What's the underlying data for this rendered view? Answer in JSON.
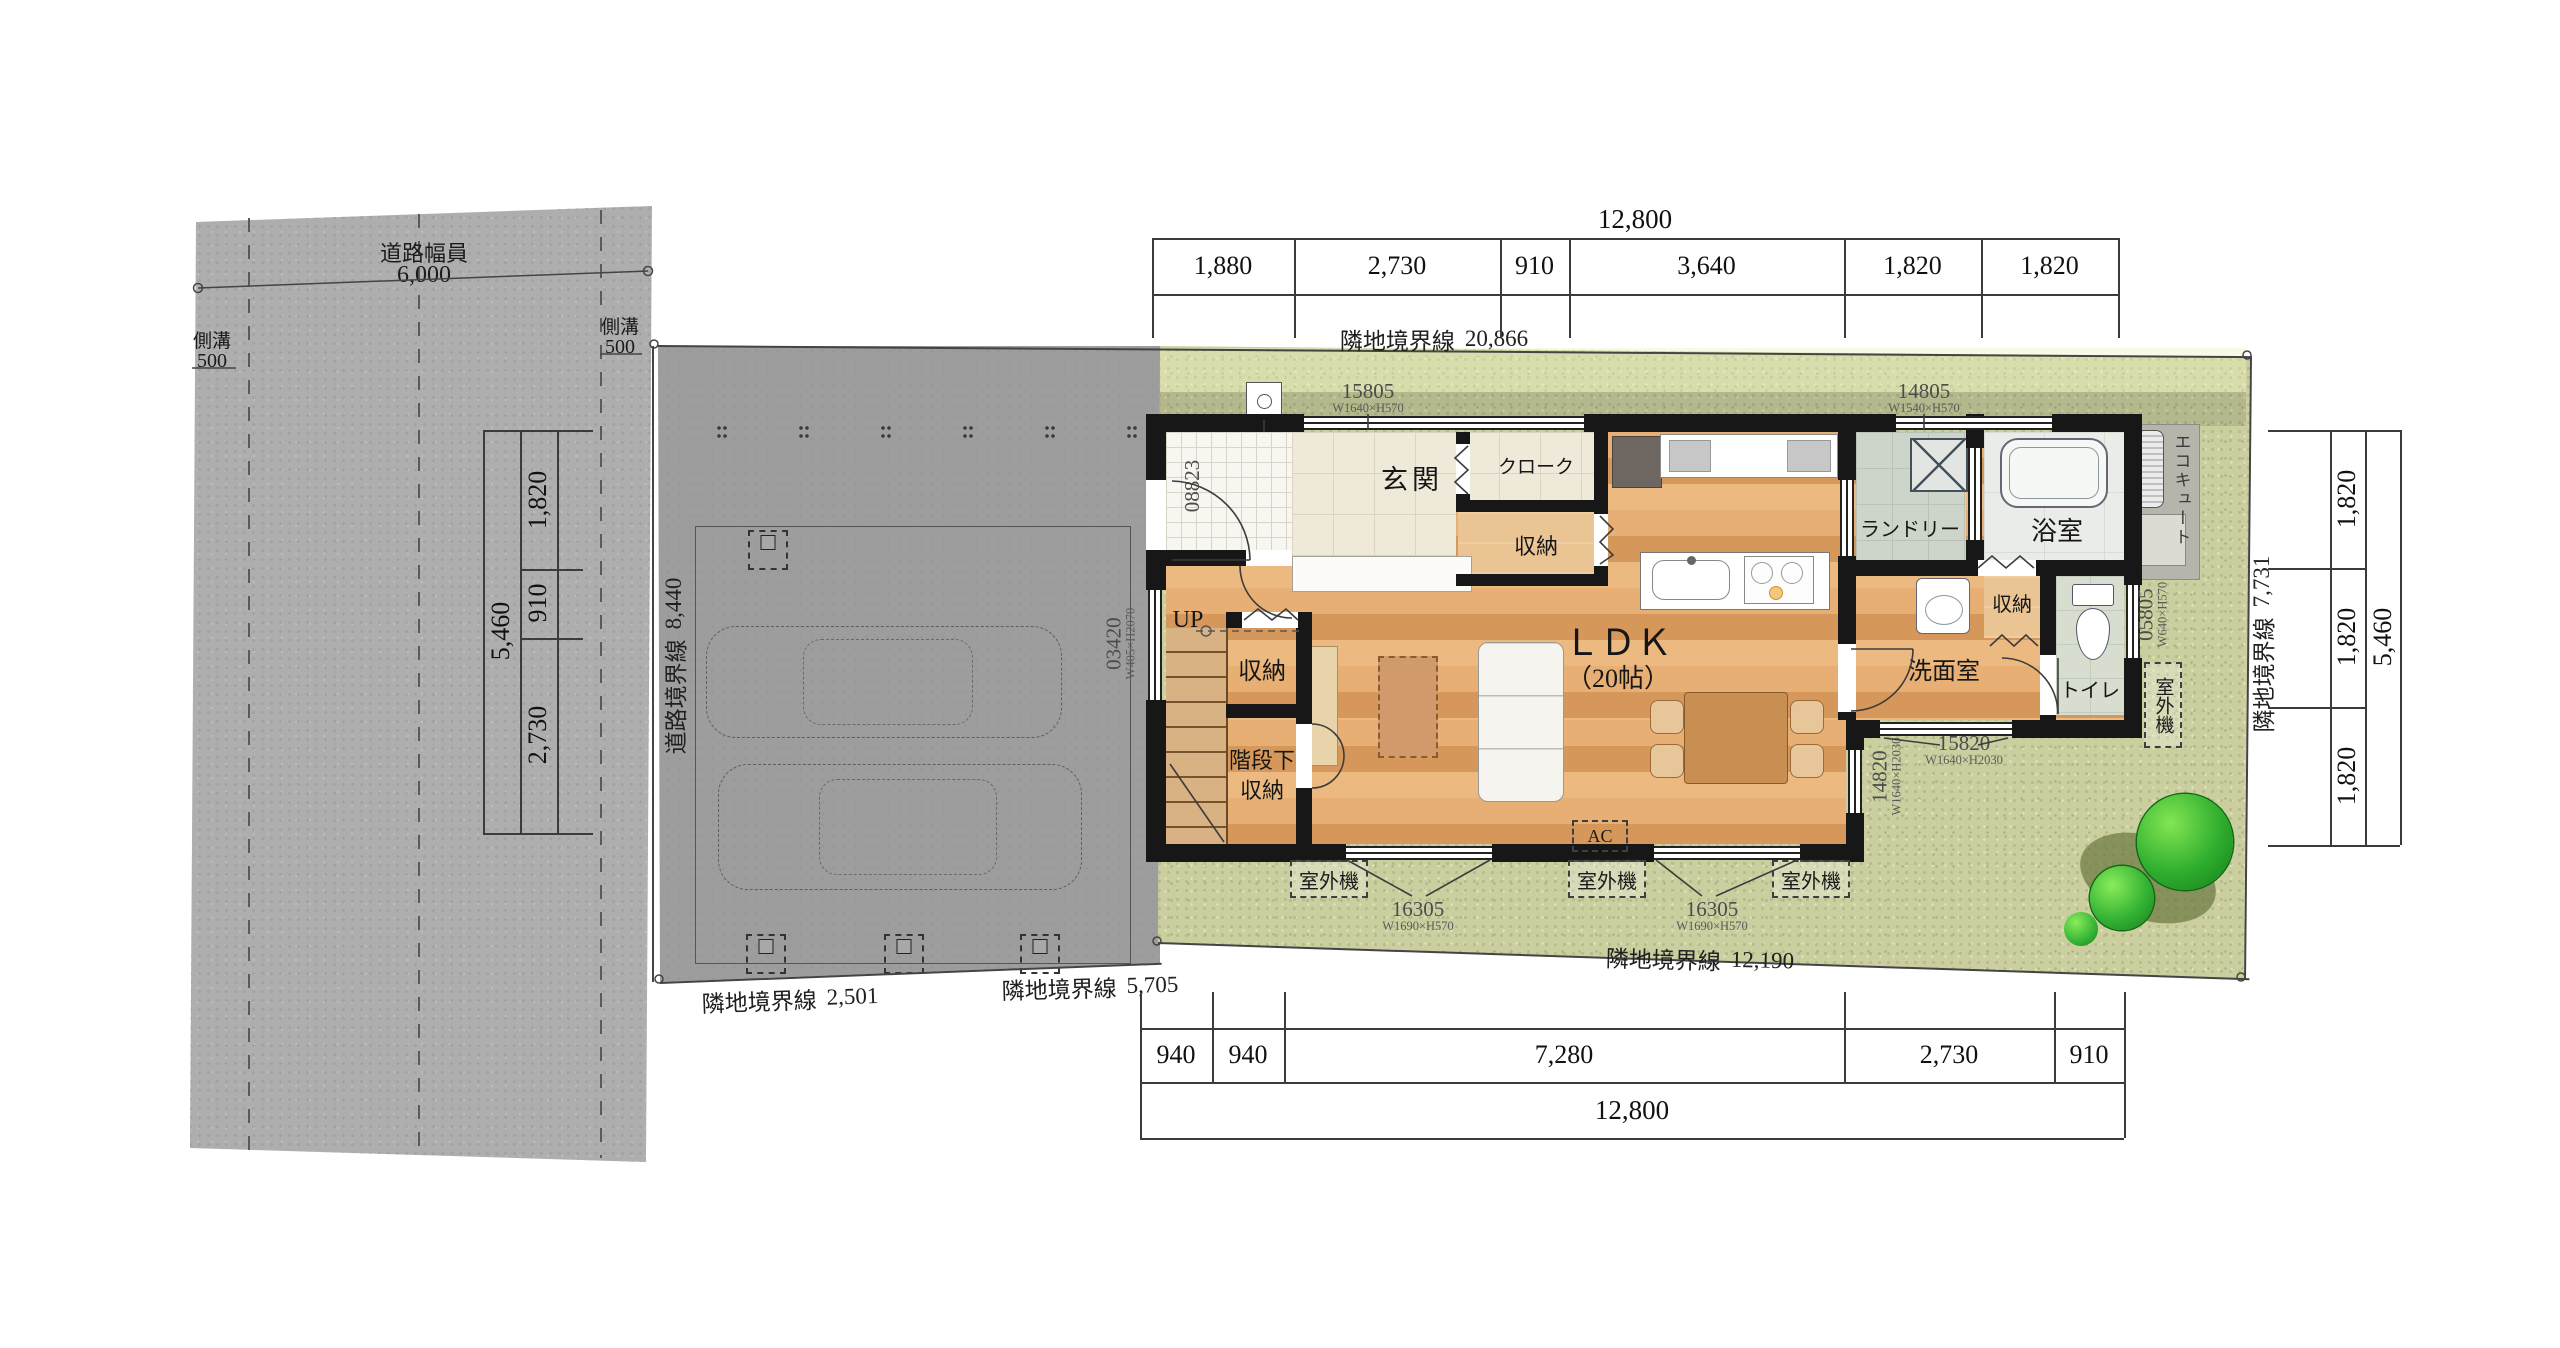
{
  "road": {
    "width_label": "道路幅員",
    "width_value": "6,000",
    "gutter_label": "側溝",
    "gutter_value": "500"
  },
  "boundaries": {
    "top_label": "隣地境界線",
    "top_value": "20,866",
    "bottom_label": "隣地境界線",
    "bottom_value": "12,190",
    "right_label": "隣地境界線",
    "right_value": "7,731",
    "road_label": "道路境界線",
    "road_value": "8,440",
    "southwest_label": "隣地境界線",
    "southwest_value": "2,501",
    "south_label": "隣地境界線",
    "south_value": "5,705"
  },
  "dims": {
    "top": {
      "total": "12,800",
      "segments": [
        "1,880",
        "2,730",
        "910",
        "3,640",
        "1,820",
        "1,820"
      ]
    },
    "bottom": {
      "total": "12,800",
      "segments": [
        "940",
        "940",
        "7,280",
        "2,730",
        "910"
      ]
    },
    "left": {
      "total": "5,460",
      "segments": [
        "1,820",
        "910",
        "2,730"
      ]
    },
    "right": {
      "total": "5,460",
      "segments": [
        "1,820",
        "1,820",
        "1,820"
      ]
    }
  },
  "rooms": {
    "entrance": "玄関",
    "cloak": "クローク",
    "storage_a": "収納",
    "storage_b": "収納",
    "storage_c": "収納",
    "stair_storage_line1": "階段下",
    "stair_storage_line2": "収納",
    "ldk": "ＬＤＫ",
    "ldk_size": "（20帖）",
    "up": "UP",
    "laundry": "ランドリー",
    "bath": "浴室",
    "washroom": "洗面室",
    "toilet": "トイレ"
  },
  "equipment": {
    "ecocute": "エコキュート",
    "outdoor_unit": "室外機",
    "ac": "AC"
  },
  "openings": {
    "w15805": {
      "code": "15805",
      "size": "W1640×H570"
    },
    "w14805": {
      "code": "14805",
      "size": "W1540×H570"
    },
    "w16305": {
      "code": "16305",
      "size": "W1690×H570"
    },
    "w15820": {
      "code": "15820",
      "size": "W1640×H2030"
    },
    "w14820": {
      "code": "14820",
      "size": "W1640×H2030"
    },
    "w05805": {
      "code": "05805",
      "size": "W640×H570"
    },
    "w08823": {
      "code": "08823"
    },
    "w03420": {
      "code": "03420",
      "size": "W405×H2070"
    }
  }
}
